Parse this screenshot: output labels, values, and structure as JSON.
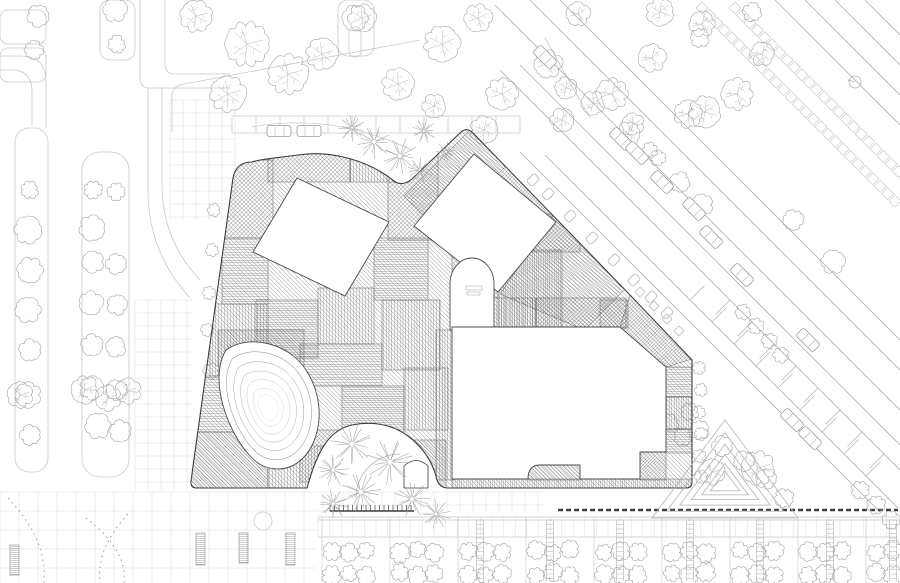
{
  "meta": {
    "kind": "architectural-site-plan",
    "canvas": {
      "w": 900,
      "h": 583
    }
  },
  "palette": {
    "bg": "#ffffff",
    "building_line": "#3d3d3d",
    "hatch": "#555555",
    "courtyard_line": "#4a4a4a",
    "contour": "#8c8c8c",
    "context": "#b0b0b0",
    "context_light": "#c9c9c9",
    "grid": "#dcdcdc",
    "tree": "#a3a3a3",
    "tree_light": "#b8b8b8",
    "dark_band": "#3f3f3f",
    "white": "#ffffff"
  },
  "building": {
    "outline": "M252,162 Q236,162 233,178 L191,481 Q190,488 197,488 L307,488 C318,448 330,430 352,425 C372,421 392,424 408,436 C424,448 432,462 436,476 Q438,488 448,488 L686,488 Q692,488 692,482 L692,360 L630,295 L473,133 Q467,127 461,132 L412,179 Q402,187 394,181 C368,160 330,150 298,155 C276,158 260,159 252,162 Z",
    "base_hatch": {
      "a": 45,
      "g": 3
    },
    "patches": [
      {
        "r": [
          225,
          160,
          48,
          78
        ],
        "a": -45,
        "g": 3
      },
      {
        "r": [
          222,
          238,
          46,
          66
        ],
        "a": 0,
        "g": 2.6
      },
      {
        "r": [
          210,
          304,
          58,
          72
        ],
        "a": 90,
        "g": 3
      },
      {
        "r": [
          196,
          376,
          54,
          56
        ],
        "a": 0,
        "g": 2.6
      },
      {
        "r": [
          190,
          432,
          78,
          56
        ],
        "a": 45,
        "g": 2.2
      },
      {
        "r": [
          268,
          446,
          66,
          42
        ],
        "a": 90,
        "g": 3
      },
      {
        "r": [
          268,
          140,
          82,
          42
        ],
        "a": -45,
        "g": 3
      },
      {
        "r": [
          350,
          128,
          60,
          54
        ],
        "a": 90,
        "g": 3
      },
      {
        "r": [
          388,
          152,
          50,
          88
        ],
        "a": -45,
        "g": 3
      },
      {
        "r": [
          256,
          300,
          62,
          58
        ],
        "a": 0,
        "g": 2.3
      },
      {
        "r": [
          318,
          288,
          56,
          56
        ],
        "a": 90,
        "g": 3
      },
      {
        "r": [
          374,
          238,
          54,
          62
        ],
        "a": 0,
        "g": 2.4
      },
      {
        "r": [
          300,
          344,
          82,
          42
        ],
        "a": 0,
        "g": 2.6
      },
      {
        "r": [
          382,
          300,
          58,
          70
        ],
        "a": 90,
        "g": 2.8
      },
      {
        "r": [
          342,
          386,
          62,
          56
        ],
        "a": 0,
        "g": 2.2
      },
      {
        "r": [
          404,
          368,
          44,
          62
        ],
        "a": 90,
        "g": 2.8
      },
      {
        "r": [
          436,
          330,
          18,
          150
        ],
        "a": 90,
        "g": 2.8
      },
      {
        "r": [
          300,
          430,
          62,
          52
        ],
        "a": -45,
        "g": 2.6
      },
      {
        "r": [
          218,
          330,
          86,
          36
        ],
        "a": 45,
        "g": 2.2
      },
      {
        "p": "404,196 472,128 508,164 440,232",
        "a": 38,
        "g": 2.6
      },
      {
        "p": "508,164 556,212 488,282 440,232",
        "a": -52,
        "g": 2.6
      },
      {
        "p": "556,212 628,286 584,330 500,294",
        "a": 38,
        "g": 2.8
      },
      {
        "r": [
          452,
          298,
          84,
          30
        ],
        "a": 90,
        "g": 2.6
      },
      {
        "r": [
          536,
          298,
          90,
          30
        ],
        "a": -45,
        "g": 2.8
      },
      {
        "p": "620,327 630,295 692,359 666,367",
        "a": -45,
        "g": 2.4
      },
      {
        "r": [
          666,
          367,
          26,
          30
        ],
        "a": 0,
        "g": 2.4
      },
      {
        "r": [
          666,
          397,
          26,
          32
        ],
        "a": 90,
        "g": 2.4
      },
      {
        "r": [
          666,
          429,
          26,
          24
        ],
        "a": 0,
        "g": 2.4
      },
      {
        "r": [
          640,
          452,
          26,
          28
        ],
        "a": -45,
        "g": 2.2
      },
      {
        "r": [
          452,
          479,
          240,
          9
        ],
        "a": 90,
        "g": 2.2
      },
      {
        "r": [
          528,
          465,
          52,
          15
        ],
        "a": 45,
        "g": 2.4
      },
      {
        "r": [
          498,
          250,
          64,
          80
        ],
        "a": 90,
        "g": 2.2
      },
      {
        "r": [
          498,
          214,
          82,
          38
        ],
        "a": -45,
        "g": 2.8
      },
      {
        "r": [
          452,
          240,
          46,
          58
        ],
        "a": -45,
        "g": 3.4
      },
      {
        "r": [
          600,
          300,
          28,
          28
        ],
        "a": 45,
        "g": 2.4
      },
      {
        "r": [
          342,
          440,
          104,
          48
        ],
        "a": 45,
        "g": 2.2
      }
    ],
    "courtyards": [
      {
        "name": "nw-courtyard",
        "path": "M297,178 L389,222 L345,296 L253,252 Z"
      },
      {
        "name": "ne-courtyard",
        "path": "M414,226 L474,154 L556,222 L498,292 Z"
      },
      {
        "name": "arched-courtyard",
        "path": "M450,330 L450,284 A22,26 0 0 1 494,284 L494,330 Z"
      },
      {
        "name": "teardrop-courtyard",
        "path": "M226,350 C248,334 288,342 306,370 C326,400 322,440 302,459 C286,474 264,471 251,457 C228,433 208,380 226,350 Z"
      },
      {
        "name": "main-courtyard",
        "path": "M452,327 L620,327 L666,367 L666,452 L640,452 L640,479 L580,479 L580,465 L540,465 Q528,465 528,479 L452,479 Z"
      }
    ],
    "door": "M404,488 L404,466 Q416,455 428,466 L428,488 Z"
  },
  "landscape": {
    "teardrop_contours": {
      "focus": [
        268,
        408
      ],
      "levels": [
        0.85,
        0.7,
        0.56,
        0.43,
        0.3,
        0.2
      ]
    },
    "triangle_mound": {
      "pts": [
        [
          652,
          518
        ],
        [
          798,
          518
        ],
        [
          725,
          420
        ]
      ],
      "center": [
        725,
        484
      ],
      "levels": [
        1,
        0.8,
        0.62,
        0.46,
        0.32,
        0.2
      ]
    },
    "plaza_arc": "M356,498 A44,44 0 0 1 400,454"
  },
  "context": {
    "road_segments": [
      [
        520,
        152,
        880,
        512
      ],
      [
        545,
        155,
        898,
        508
      ],
      [
        500,
        70,
        900,
        470
      ],
      [
        520,
        65,
        900,
        445
      ],
      [
        495,
        5,
        900,
        410
      ],
      [
        530,
        0,
        900,
        370
      ],
      [
        560,
        0,
        900,
        340
      ],
      [
        775,
        0,
        900,
        125
      ],
      [
        805,
        0,
        900,
        95
      ],
      [
        835,
        0,
        900,
        65
      ],
      [
        865,
        0,
        900,
        35
      ]
    ],
    "crosswalk_ladders": [
      {
        "x": 702,
        "y": 2,
        "len": 280
      },
      {
        "x": 735,
        "y": 2,
        "len": 232
      }
    ],
    "tick_rows": [
      {
        "c": 390,
        "x1": 690,
        "x2": 886,
        "step": 22,
        "dx": 9,
        "dy": -9
      },
      {
        "c": 430,
        "x1": 730,
        "x2": 898,
        "step": 22,
        "dx": -9,
        "dy": 9
      }
    ],
    "left_paths": [
      "M0,56 L20,56 Q46,56 46,82 L46,128",
      "M0,70 L12,70 Q32,70 32,92 L32,126",
      "M140,0 L140,78 Q140,88 150,88 L230,88",
      "M165,0 L165,64 Q165,74 175,74 L230,74",
      "M148,88 L148,190 Q148,252 190,298",
      "M162,88 L162,185 Q162,240 200,280",
      "M172,132 L172,96 Q172,86 184,84 L420,40",
      "M545,38 L590,118",
      "M252,127 Q330,112 412,150"
    ],
    "strips": [
      {
        "r": [
          15,
          128,
          33,
          344
        ],
        "rx": 14
      },
      {
        "r": [
          82,
          152,
          47,
          325
        ],
        "rx": 18
      },
      {
        "r": [
          0,
          10,
          46,
          34
        ],
        "rx": 8
      },
      {
        "r": [
          0,
          48,
          46,
          34
        ],
        "rx": 8
      },
      {
        "r": [
          100,
          0,
          35,
          60
        ],
        "rx": 10
      },
      {
        "r": [
          338,
          0,
          36,
          56
        ],
        "rx": 10
      }
    ],
    "stall_band": {
      "x1": 232,
      "x2": 520,
      "y1": 116,
      "y2": 133,
      "step": 24
    },
    "grids": [
      {
        "r": [
          0,
          492,
          330,
          91
        ],
        "cell": 19
      },
      {
        "r": [
          330,
          492,
          215,
          23
        ],
        "cell": 13
      },
      {
        "r": [
          170,
          100,
          65,
          120
        ],
        "cell": 13
      },
      {
        "r": [
          135,
          300,
          58,
          190
        ],
        "cell": 13
      }
    ],
    "dotted_arcs": [
      "M8,498 Q48,540 44,583",
      "M86,518 Q128,550 124,583",
      "M128,514 Q96,548 100,583"
    ],
    "comb": {
      "x1": 330,
      "x2": 414,
      "y": 511,
      "tooth": 6,
      "step": 4.5
    },
    "dashed_band": {
      "x1": 558,
      "y1": 510,
      "x2": 898,
      "y2": 510
    },
    "planters": [
      [
        10,
        545,
        9,
        30
      ],
      [
        196,
        533,
        9,
        32
      ],
      [
        239,
        533,
        9,
        30
      ],
      [
        286,
        533,
        9,
        32
      ]
    ],
    "planter_circle": [
      263,
      521,
      9
    ],
    "north_marker": {
      "x": 855,
      "y": 82,
      "r": 6
    }
  },
  "orchard": {
    "bg": [
      316,
      512,
      584,
      71
    ],
    "top_lines": [
      517,
      520,
      537
    ],
    "x1": 318,
    "x2": 898,
    "col_step": 11.6,
    "bay_step": 68,
    "bay_x0": 322,
    "ladder_xs": [
      480,
      550,
      620,
      690,
      760,
      830,
      893
    ],
    "tree_rows": [
      551,
      574
    ],
    "group_x0": 332,
    "group_step": 68,
    "group_count": 9,
    "tree_dx": 17
  },
  "trees": {
    "decid": [
      [
        196,
        16,
        15
      ],
      [
        247,
        44,
        21
      ],
      [
        288,
        74,
        19
      ],
      [
        228,
        94,
        17
      ],
      [
        322,
        54,
        15
      ],
      [
        362,
        18,
        13
      ],
      [
        398,
        84,
        15
      ],
      [
        442,
        44,
        17
      ],
      [
        478,
        18,
        13
      ],
      [
        502,
        94,
        15
      ],
      [
        548,
        64,
        13
      ],
      [
        578,
        14,
        11
      ],
      [
        612,
        94,
        15
      ],
      [
        652,
        58,
        13
      ],
      [
        702,
        24,
        12
      ],
      [
        737,
        94,
        15
      ],
      [
        762,
        54,
        11
      ],
      [
        688,
        114,
        13
      ],
      [
        628,
        134,
        11
      ],
      [
        562,
        120,
        11
      ],
      [
        484,
        130,
        13
      ],
      [
        434,
        106,
        11
      ],
      [
        660,
        12,
        13
      ],
      [
        705,
        112,
        15
      ],
      [
        566,
        88,
        10
      ],
      [
        593,
        103,
        11
      ],
      [
        633,
        124,
        10
      ],
      [
        85,
        390,
        13
      ],
      [
        108,
        398,
        12
      ],
      [
        128,
        391,
        12
      ],
      [
        20,
        395,
        12
      ],
      [
        758,
        468,
        16
      ],
      [
        712,
        472,
        12
      ]
    ],
    "scal": [
      [
        38,
        16,
        10
      ],
      [
        34,
        50,
        8
      ],
      [
        115,
        10,
        11
      ],
      [
        117,
        44,
        7
      ],
      [
        30,
        190,
        7
      ],
      [
        28,
        230,
        13
      ],
      [
        30,
        270,
        12
      ],
      [
        28,
        310,
        12
      ],
      [
        30,
        350,
        10
      ],
      [
        28,
        395,
        12
      ],
      [
        30,
        435,
        9
      ],
      [
        93,
        190,
        7
      ],
      [
        116,
        192,
        7
      ],
      [
        92,
        228,
        12
      ],
      [
        93,
        262,
        10
      ],
      [
        116,
        264,
        9
      ],
      [
        91,
        303,
        11
      ],
      [
        117,
        305,
        9
      ],
      [
        92,
        345,
        10
      ],
      [
        116,
        347,
        9
      ],
      [
        92,
        388,
        11
      ],
      [
        116,
        390,
        9
      ],
      [
        98,
        426,
        12
      ],
      [
        120,
        431,
        10
      ],
      [
        214,
        210,
        5
      ],
      [
        212,
        250,
        5
      ],
      [
        209,
        293,
        5
      ],
      [
        207,
        330,
        5
      ],
      [
        211,
        371,
        6
      ],
      [
        700,
        38,
        8
      ],
      [
        752,
        12,
        8
      ],
      [
        793,
        220,
        9
      ],
      [
        833,
        262,
        11
      ],
      [
        680,
        182,
        9
      ],
      [
        702,
        205,
        10
      ],
      [
        650,
        150,
        6
      ],
      [
        658,
        158,
        6
      ],
      [
        588,
        338,
        7
      ],
      [
        602,
        352,
        7
      ],
      [
        616,
        366,
        7
      ],
      [
        630,
        381,
        7
      ],
      [
        644,
        395,
        7
      ],
      [
        657,
        409,
        7
      ],
      [
        670,
        423,
        7
      ],
      [
        683,
        437,
        7
      ],
      [
        743,
        312,
        6
      ],
      [
        756,
        326,
        6
      ],
      [
        769,
        341,
        6
      ],
      [
        781,
        355,
        6
      ],
      [
        700,
        430,
        8
      ],
      [
        722,
        446,
        9
      ],
      [
        744,
        461,
        9
      ],
      [
        766,
        479,
        9
      ],
      [
        784,
        498,
        8
      ],
      [
        690,
        412,
        7
      ],
      [
        860,
        490,
        7
      ],
      [
        876,
        505,
        7
      ],
      [
        891,
        520,
        7
      ],
      [
        699,
        368,
        5
      ],
      [
        701,
        390,
        5
      ],
      [
        699,
        412,
        5
      ],
      [
        701,
        434,
        5
      ],
      [
        699,
        456,
        5
      ],
      [
        701,
        477,
        5
      ],
      [
        466,
        258,
        5
      ],
      [
        478,
        316,
        4
      ],
      [
        459,
        306,
        3
      ]
    ],
    "spiky": [
      [
        352,
        128,
        12
      ],
      [
        374,
        142,
        15
      ],
      [
        400,
        156,
        16
      ],
      [
        424,
        131,
        11
      ],
      [
        420,
        170,
        11
      ],
      [
        446,
        152,
        9
      ],
      [
        352,
        444,
        19
      ],
      [
        390,
        462,
        21
      ],
      [
        361,
        492,
        18
      ],
      [
        412,
        499,
        16
      ],
      [
        333,
        470,
        14
      ],
      [
        436,
        514,
        13
      ],
      [
        333,
        504,
        13
      ]
    ],
    "lollipop": [
      [
        355,
        18,
        12
      ]
    ]
  },
  "cars": {
    "horizontal": [
      [
        279,
        131
      ],
      [
        309,
        131
      ]
    ],
    "diagonal": [
      [
        545,
        57
      ],
      [
        621,
        139
      ],
      [
        637,
        153
      ],
      [
        662,
        182
      ],
      [
        694,
        209
      ],
      [
        711,
        237
      ],
      [
        742,
        275
      ],
      [
        808,
        340
      ],
      [
        792,
        420
      ],
      [
        810,
        438
      ]
    ]
  },
  "furniture": {
    "tables": [
      [
        548,
        194
      ],
      [
        570,
        216
      ],
      [
        592,
        238
      ],
      [
        614,
        260
      ],
      [
        634,
        280
      ],
      [
        651,
        297
      ],
      [
        667,
        313
      ],
      [
        533,
        180
      ]
    ],
    "small_squares": [
      [
        640,
        292
      ],
      [
        654,
        306
      ],
      [
        667,
        319
      ],
      [
        679,
        331
      ]
    ],
    "court_marks": [
      [
        466,
        286,
        16,
        4
      ],
      [
        467,
        292,
        13,
        3
      ]
    ]
  }
}
